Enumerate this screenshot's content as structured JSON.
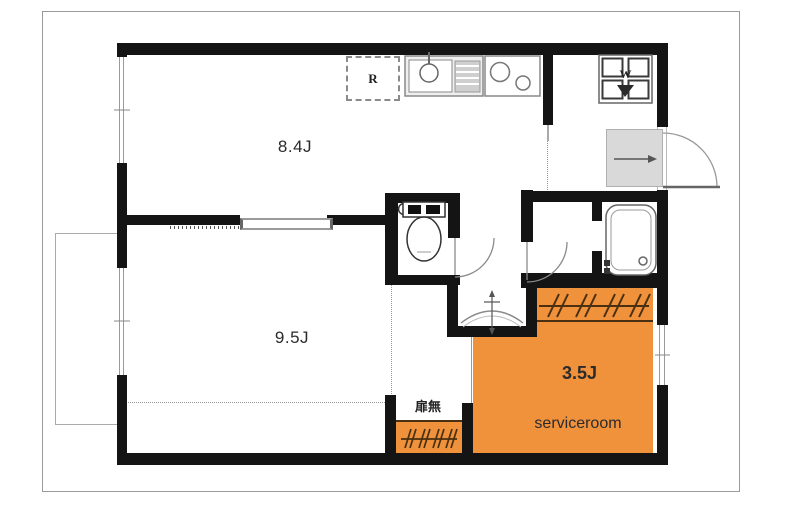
{
  "title": "apartment-floor-plan",
  "rooms": {
    "living": {
      "label": "8.4J"
    },
    "bedroom": {
      "label": "9.5J"
    },
    "serviceroom": {
      "label": "3.5J",
      "sublabel": "serviceroom"
    }
  },
  "annotations": {
    "no_door": "扉無"
  },
  "fixtures": {
    "refrigerator_label": "R",
    "washer_label": "W",
    "icons": [
      "toilet-icon",
      "bathtub-icon",
      "kitchen-sink-icon",
      "stove-icon",
      "washbasin-icon",
      "washer-pan-icon",
      "hanger-pipe-icon",
      "entrance-door-swing"
    ]
  },
  "colors": {
    "serviceroom_fill": "#F0913C",
    "wall": "#141414",
    "closet_line": "#4a3010"
  }
}
